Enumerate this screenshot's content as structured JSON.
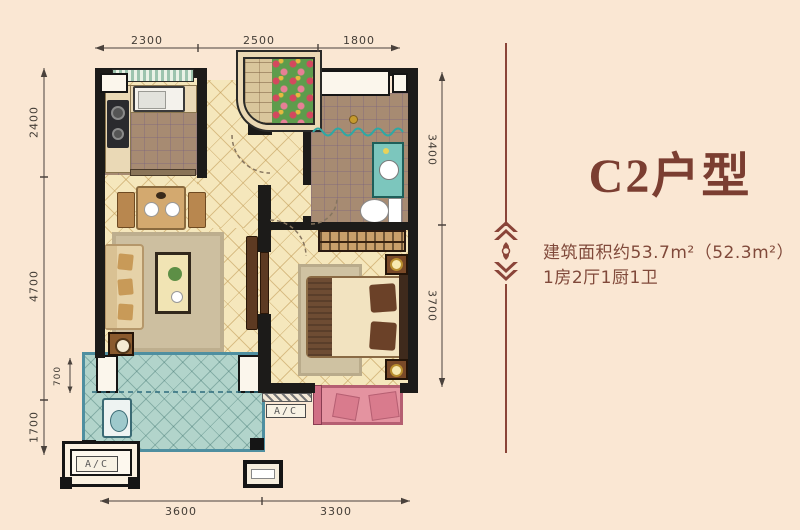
{
  "title_block": {
    "title": "C2户型",
    "area_line": "建筑面积约53.7m²（52.3m²）",
    "rooms_line": "1房2厅1厨1卫"
  },
  "dimensions": {
    "top": [
      "2300",
      "2500",
      "1800"
    ],
    "bottom": [
      "3600",
      "3300"
    ],
    "left": [
      "2400",
      "4700",
      "1700"
    ],
    "left_inner": "700",
    "right": [
      "3400",
      "3700"
    ]
  },
  "labels": {
    "ac": "A/C"
  },
  "colors": {
    "background": "#fae7d3",
    "accent_maroon": "#7b3e31",
    "wall": "#1c1b19",
    "floor_warm": "#f5e7bc",
    "tile_brown": "#a78b72",
    "balcony_teal": "#b2d4cb",
    "bay_window_pink": "#e493a0",
    "dimension_text": "#433d36"
  }
}
